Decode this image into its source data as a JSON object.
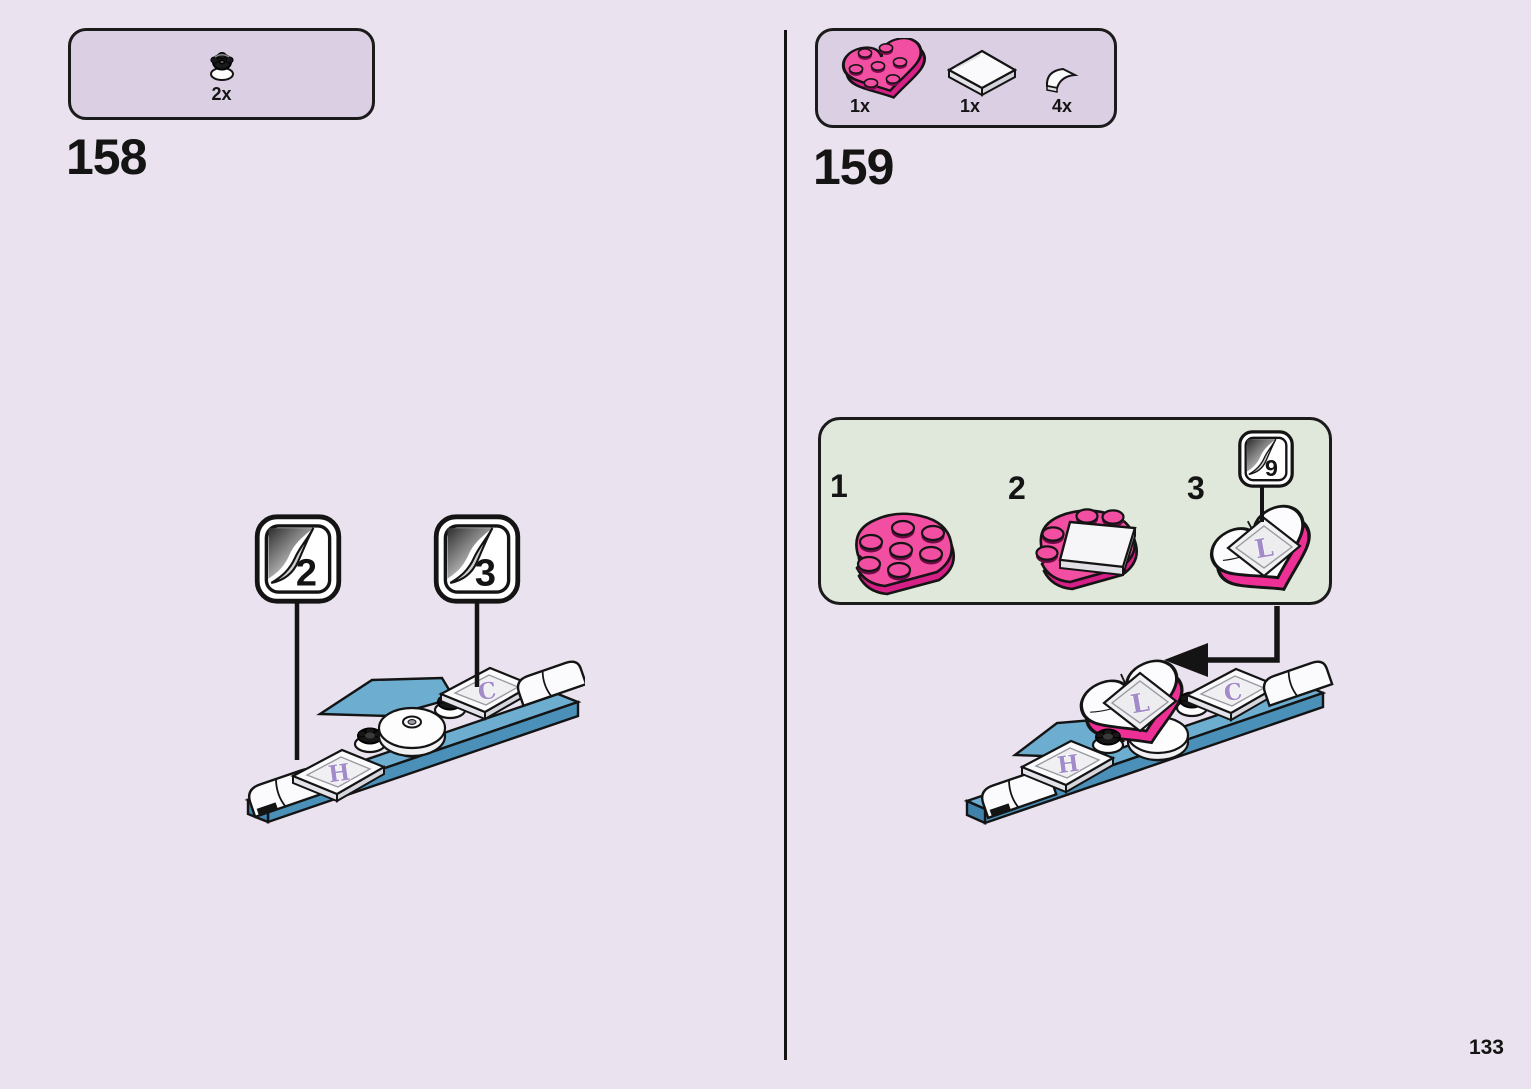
{
  "page": {
    "number": "133"
  },
  "colors": {
    "background": "#eae2ee",
    "parts_panel": "#dbcfe4",
    "substeps_panel": "#dfe8db",
    "outline": "#141414",
    "pink_brick": "#f24fa3",
    "pink_brick_dark": "#d61f87",
    "magenta_side": "#ee2f96",
    "blue_brick": "#6cadd0",
    "blue_brick_dark": "#4b90b8",
    "letter_purple": "#a28bc9",
    "white_brick": "#fbfbfd"
  },
  "step158": {
    "number": "158",
    "parts": [
      {
        "name": "black-flower-plate-1x1",
        "count": "2x"
      }
    ],
    "sticker_callouts": [
      {
        "number": "2"
      },
      {
        "number": "3"
      }
    ],
    "model_letters": {
      "h": "H",
      "c": "C"
    }
  },
  "step159": {
    "number": "159",
    "parts": [
      {
        "name": "pink-heart-plate-3x3",
        "count": "1x"
      },
      {
        "name": "white-tile-2x2",
        "count": "1x"
      },
      {
        "name": "white-quarter-tile-1x1",
        "count": "4x"
      }
    ],
    "substeps": [
      {
        "label": "1"
      },
      {
        "label": "2"
      },
      {
        "label": "3"
      }
    ],
    "sticker_callout": {
      "number": "9"
    },
    "substep_letter_l": "L",
    "model_letters": {
      "h": "H",
      "c": "C",
      "l": "L"
    }
  }
}
